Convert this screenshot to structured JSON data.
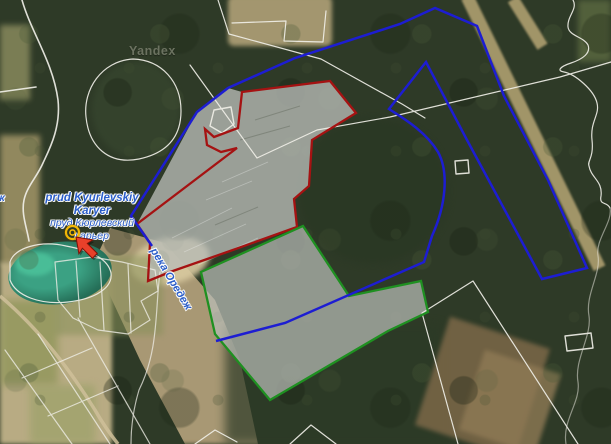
{
  "map": {
    "watermark": "Yandex",
    "poi": {
      "name_latin_line1": "prud Kyurlevskiy",
      "name_latin_line2": "Karyer",
      "name_cyrillic_line1": "пруд Кюрлевский",
      "name_cyrillic_line2": "карьер"
    },
    "river_label": "река Оредеж",
    "edge_label_fragment": "ж",
    "colors": {
      "parcel_blue": "#1d1dd2",
      "parcel_red": "#a51212",
      "parcel_green": "#1f9021",
      "cadastral_white": "#f0efe8",
      "area_fill_gray": "#b9bdb7",
      "label_blue": "#2b5ec9",
      "marker_red": "#e8402a",
      "marker_red_outline": "#7e1006",
      "poi_ring_yellow": "#f2b705",
      "pond_teal": "#2d8a6f",
      "road_tan": "#cfc09a"
    }
  }
}
